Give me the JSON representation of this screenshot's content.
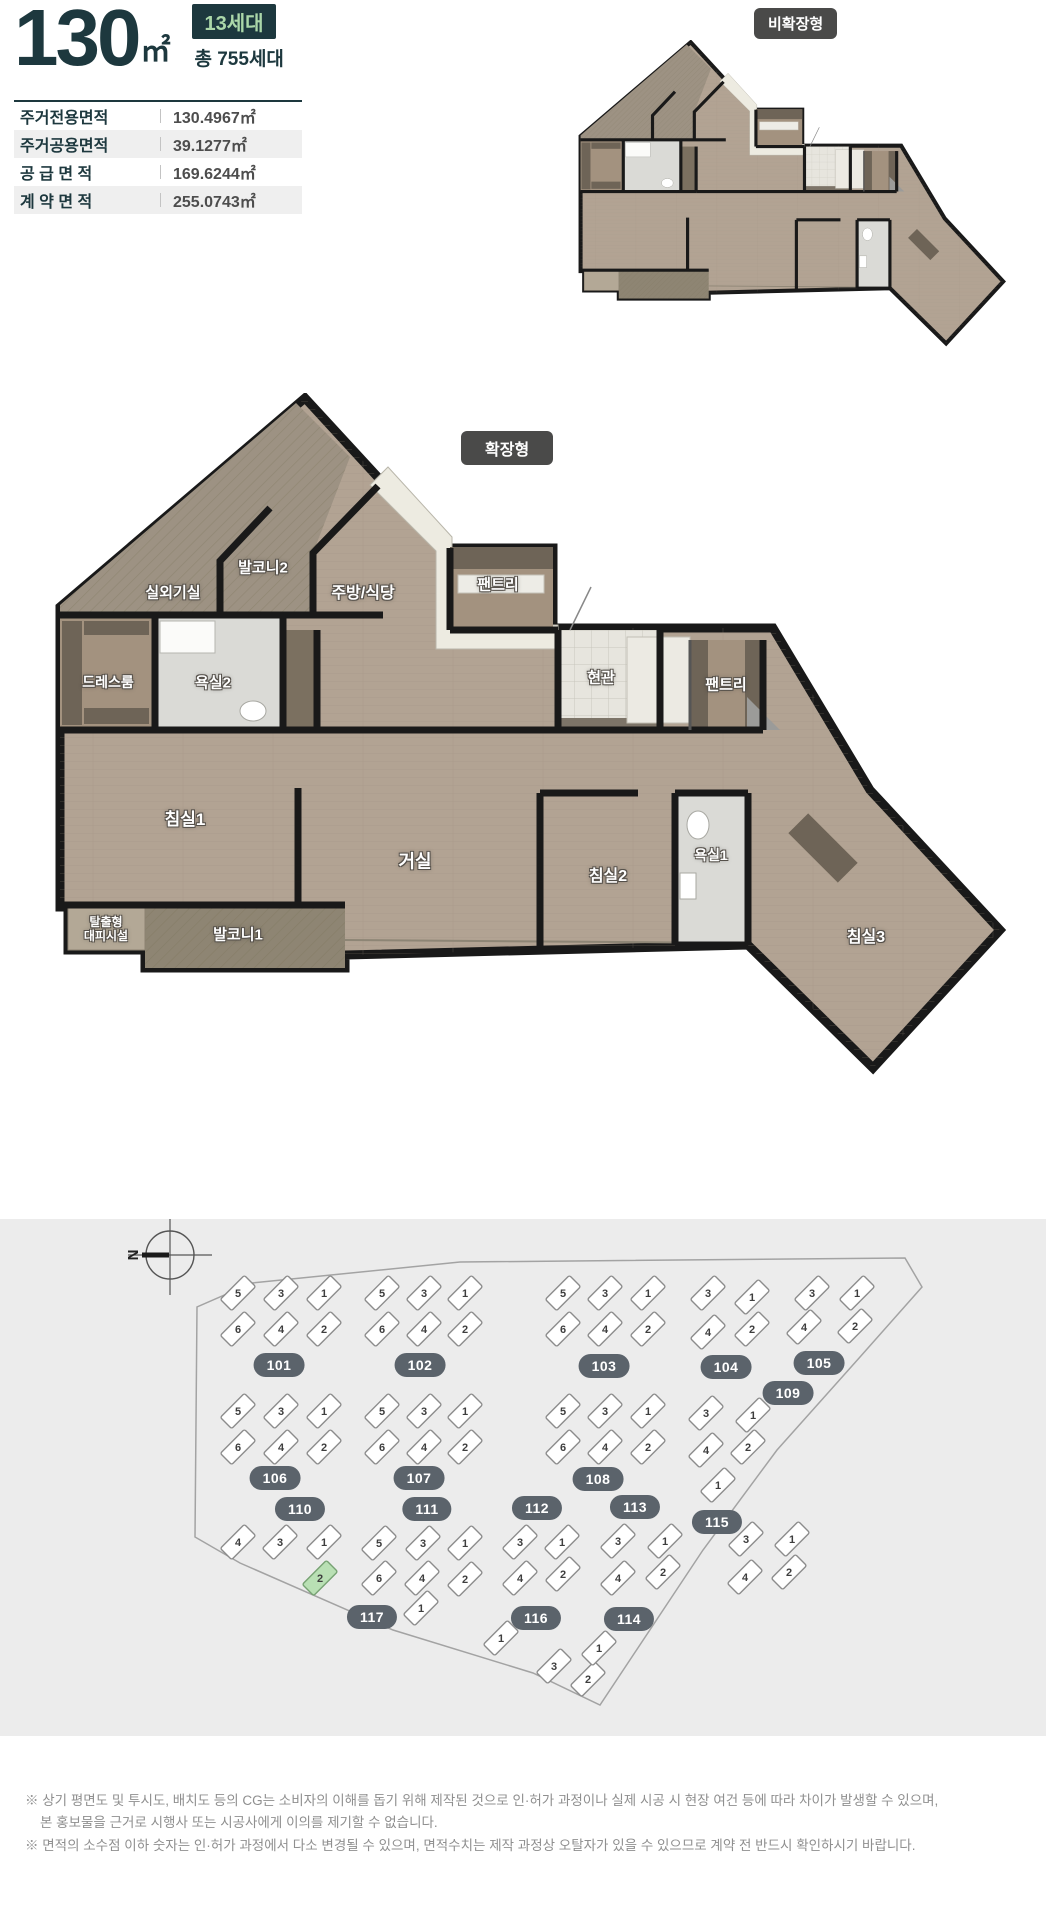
{
  "header": {
    "size": "130",
    "size_unit": "㎡",
    "units_badge": "13세대",
    "total_units": "총 755세대"
  },
  "area_table": [
    {
      "label": "주거전용면적",
      "value": "130.4967㎡"
    },
    {
      "label": "주거공용면적",
      "value": "39.1277㎡"
    },
    {
      "label": "공 급 면 적",
      "value": "169.6244㎡"
    },
    {
      "label": "계 약 면 적",
      "value": "255.0743㎡"
    }
  ],
  "badges": {
    "non_expanded": "비확장형",
    "expanded": "확장형"
  },
  "expanded_plan_rooms": [
    {
      "name": "실외기실",
      "x": 125,
      "y": 200,
      "s": 15
    },
    {
      "name": "발코니2",
      "x": 215,
      "y": 175,
      "s": 15
    },
    {
      "name": "주방/식당",
      "x": 315,
      "y": 201,
      "s": 16
    },
    {
      "name": "팬트리",
      "x": 450,
      "y": 192,
      "s": 15
    },
    {
      "name": "드레스룸",
      "x": 60,
      "y": 289,
      "s": 14
    },
    {
      "name": "욕실2",
      "x": 165,
      "y": 290,
      "s": 15
    },
    {
      "name": "현관",
      "x": 553,
      "y": 285,
      "s": 15
    },
    {
      "name": "팬트리",
      "x": 678,
      "y": 292,
      "s": 15
    },
    {
      "name": "침실1",
      "x": 137,
      "y": 427,
      "s": 17
    },
    {
      "name": "거실",
      "x": 367,
      "y": 469,
      "s": 18
    },
    {
      "name": "침실2",
      "x": 560,
      "y": 484,
      "s": 16
    },
    {
      "name": "욕실1",
      "x": 663,
      "y": 462,
      "s": 14
    },
    {
      "name": "침실3",
      "x": 818,
      "y": 545,
      "s": 16
    },
    {
      "name": "발코니1",
      "x": 190,
      "y": 542,
      "s": 15
    },
    {
      "name": "탈출형\n대피시설",
      "x": 58,
      "y": 537,
      "s": 12
    }
  ],
  "site_plan": {
    "compass": "N",
    "highlight_color": "#b9e0b4",
    "clusters": [
      {
        "no": "101",
        "bx": 279,
        "by": 146,
        "units": [
          {
            "n": "5",
            "x": 238,
            "y": 74
          },
          {
            "n": "3",
            "x": 281,
            "y": 74
          },
          {
            "n": "1",
            "x": 324,
            "y": 74
          },
          {
            "n": "6",
            "x": 238,
            "y": 110
          },
          {
            "n": "4",
            "x": 281,
            "y": 110
          },
          {
            "n": "2",
            "x": 324,
            "y": 110
          }
        ]
      },
      {
        "no": "102",
        "bx": 420,
        "by": 146,
        "units": [
          {
            "n": "5",
            "x": 382,
            "y": 74
          },
          {
            "n": "3",
            "x": 424,
            "y": 74
          },
          {
            "n": "1",
            "x": 465,
            "y": 74
          },
          {
            "n": "6",
            "x": 382,
            "y": 110
          },
          {
            "n": "4",
            "x": 424,
            "y": 110
          },
          {
            "n": "2",
            "x": 465,
            "y": 110
          }
        ]
      },
      {
        "no": "103",
        "bx": 604,
        "by": 147,
        "units": [
          {
            "n": "5",
            "x": 563,
            "y": 74
          },
          {
            "n": "3",
            "x": 605,
            "y": 74
          },
          {
            "n": "1",
            "x": 648,
            "y": 74
          },
          {
            "n": "6",
            "x": 563,
            "y": 110
          },
          {
            "n": "4",
            "x": 605,
            "y": 110
          },
          {
            "n": "2",
            "x": 648,
            "y": 110
          }
        ]
      },
      {
        "no": "104",
        "bx": 726,
        "by": 148,
        "units": [
          {
            "n": "3",
            "x": 708,
            "y": 74
          },
          {
            "n": "1",
            "x": 752,
            "y": 78
          },
          {
            "n": "4",
            "x": 708,
            "y": 113
          },
          {
            "n": "2",
            "x": 752,
            "y": 110
          }
        ]
      },
      {
        "no": "105",
        "bx": 819,
        "by": 144,
        "units": [
          {
            "n": "3",
            "x": 812,
            "y": 74
          },
          {
            "n": "1",
            "x": 857,
            "y": 74
          },
          {
            "n": "4",
            "x": 804,
            "y": 108
          },
          {
            "n": "2",
            "x": 855,
            "y": 107
          }
        ]
      },
      {
        "no": "109",
        "bx": 788,
        "by": 174,
        "units": [
          {
            "n": "3",
            "x": 706,
            "y": 194
          },
          {
            "n": "1",
            "x": 753,
            "y": 196
          },
          {
            "n": "4",
            "x": 706,
            "y": 231
          },
          {
            "n": "2",
            "x": 748,
            "y": 228
          },
          {
            "n": "1",
            "x": 718,
            "y": 266
          }
        ]
      },
      {
        "no": "106",
        "bx": 275,
        "by": 259,
        "units": [
          {
            "n": "5",
            "x": 238,
            "y": 192
          },
          {
            "n": "3",
            "x": 281,
            "y": 192
          },
          {
            "n": "1",
            "x": 324,
            "y": 192
          },
          {
            "n": "6",
            "x": 238,
            "y": 228
          },
          {
            "n": "4",
            "x": 281,
            "y": 228
          },
          {
            "n": "2",
            "x": 324,
            "y": 228
          }
        ]
      },
      {
        "no": "107",
        "bx": 419,
        "by": 259,
        "units": [
          {
            "n": "5",
            "x": 382,
            "y": 192
          },
          {
            "n": "3",
            "x": 424,
            "y": 192
          },
          {
            "n": "1",
            "x": 465,
            "y": 192
          },
          {
            "n": "6",
            "x": 382,
            "y": 228
          },
          {
            "n": "4",
            "x": 424,
            "y": 228
          },
          {
            "n": "2",
            "x": 465,
            "y": 228
          }
        ]
      },
      {
        "no": "108",
        "bx": 598,
        "by": 260,
        "units": [
          {
            "n": "5",
            "x": 563,
            "y": 192
          },
          {
            "n": "3",
            "x": 605,
            "y": 192
          },
          {
            "n": "1",
            "x": 648,
            "y": 192
          },
          {
            "n": "6",
            "x": 563,
            "y": 228
          },
          {
            "n": "4",
            "x": 605,
            "y": 228
          },
          {
            "n": "2",
            "x": 648,
            "y": 228
          }
        ]
      },
      {
        "no": "113",
        "bx": 635,
        "by": 288,
        "units": [
          {
            "n": "3",
            "x": 618,
            "y": 322
          },
          {
            "n": "1",
            "x": 665,
            "y": 322
          },
          {
            "n": "4",
            "x": 618,
            "y": 359
          },
          {
            "n": "2",
            "x": 663,
            "y": 353
          }
        ]
      },
      {
        "no": "110",
        "bx": 300,
        "by": 290,
        "units": [
          {
            "n": "4",
            "x": 238,
            "y": 323
          },
          {
            "n": "3",
            "x": 280,
            "y": 323
          },
          {
            "n": "1",
            "x": 324,
            "y": 323
          }
        ]
      },
      {
        "no": "117",
        "bx": 372,
        "by": 398,
        "units": [
          {
            "n": "2",
            "x": 320,
            "y": 359,
            "hl": true
          }
        ]
      },
      {
        "no": "111",
        "bx": 427,
        "by": 290,
        "units": [
          {
            "n": "5",
            "x": 379,
            "y": 324
          },
          {
            "n": "3",
            "x": 423,
            "y": 324
          },
          {
            "n": "1",
            "x": 465,
            "y": 324
          },
          {
            "n": "6",
            "x": 379,
            "y": 359
          },
          {
            "n": "4",
            "x": 422,
            "y": 359
          },
          {
            "n": "2",
            "x": 465,
            "y": 360
          },
          {
            "n": "1",
            "x": 421,
            "y": 389
          }
        ]
      },
      {
        "no": "112",
        "bx": 537,
        "by": 289,
        "units": [
          {
            "n": "3",
            "x": 520,
            "y": 323
          },
          {
            "n": "1",
            "x": 562,
            "y": 323
          },
          {
            "n": "4",
            "x": 520,
            "y": 359
          },
          {
            "n": "2",
            "x": 563,
            "y": 355
          }
        ]
      },
      {
        "no": "115",
        "bx": 717,
        "by": 303,
        "units": []
      },
      {
        "no": "116",
        "bx": 536,
        "by": 399,
        "units": [
          {
            "n": "1",
            "x": 501,
            "y": 419
          },
          {
            "n": "3",
            "x": 554,
            "y": 447
          },
          {
            "n": "2",
            "x": 588,
            "y": 460
          },
          {
            "n": "1",
            "x": 599,
            "y": 429
          }
        ]
      },
      {
        "no": "114",
        "bx": 629,
        "by": 400,
        "units": [
          {
            "n": "3",
            "x": 746,
            "y": 320
          },
          {
            "n": "1",
            "x": 792,
            "y": 320
          },
          {
            "n": "4",
            "x": 745,
            "y": 358
          },
          {
            "n": "2",
            "x": 789,
            "y": 353
          }
        ]
      }
    ]
  },
  "footer": {
    "line1": "※ 상기 평면도 및 투시도, 배치도 등의 CG는 소비자의 이해를 돕기 위해 제작된 것으로 인·허가 과정이나 실제 시공 시 현장 여건 등에 따라 차이가 발생할 수 있으며,",
    "line2": "본 홍보물을 근거로 시행사 또는 시공사에게 이의를 제기할 수 없습니다.",
    "line3": "※ 면적의 소수점 이하 숫자는 인·허가 과정에서 다소 변경될 수 있으며, 면적수치는 제작 과정상 오탈자가 있을 수 있으므로 계약 전 반드시 확인하시기 바랍니다."
  }
}
